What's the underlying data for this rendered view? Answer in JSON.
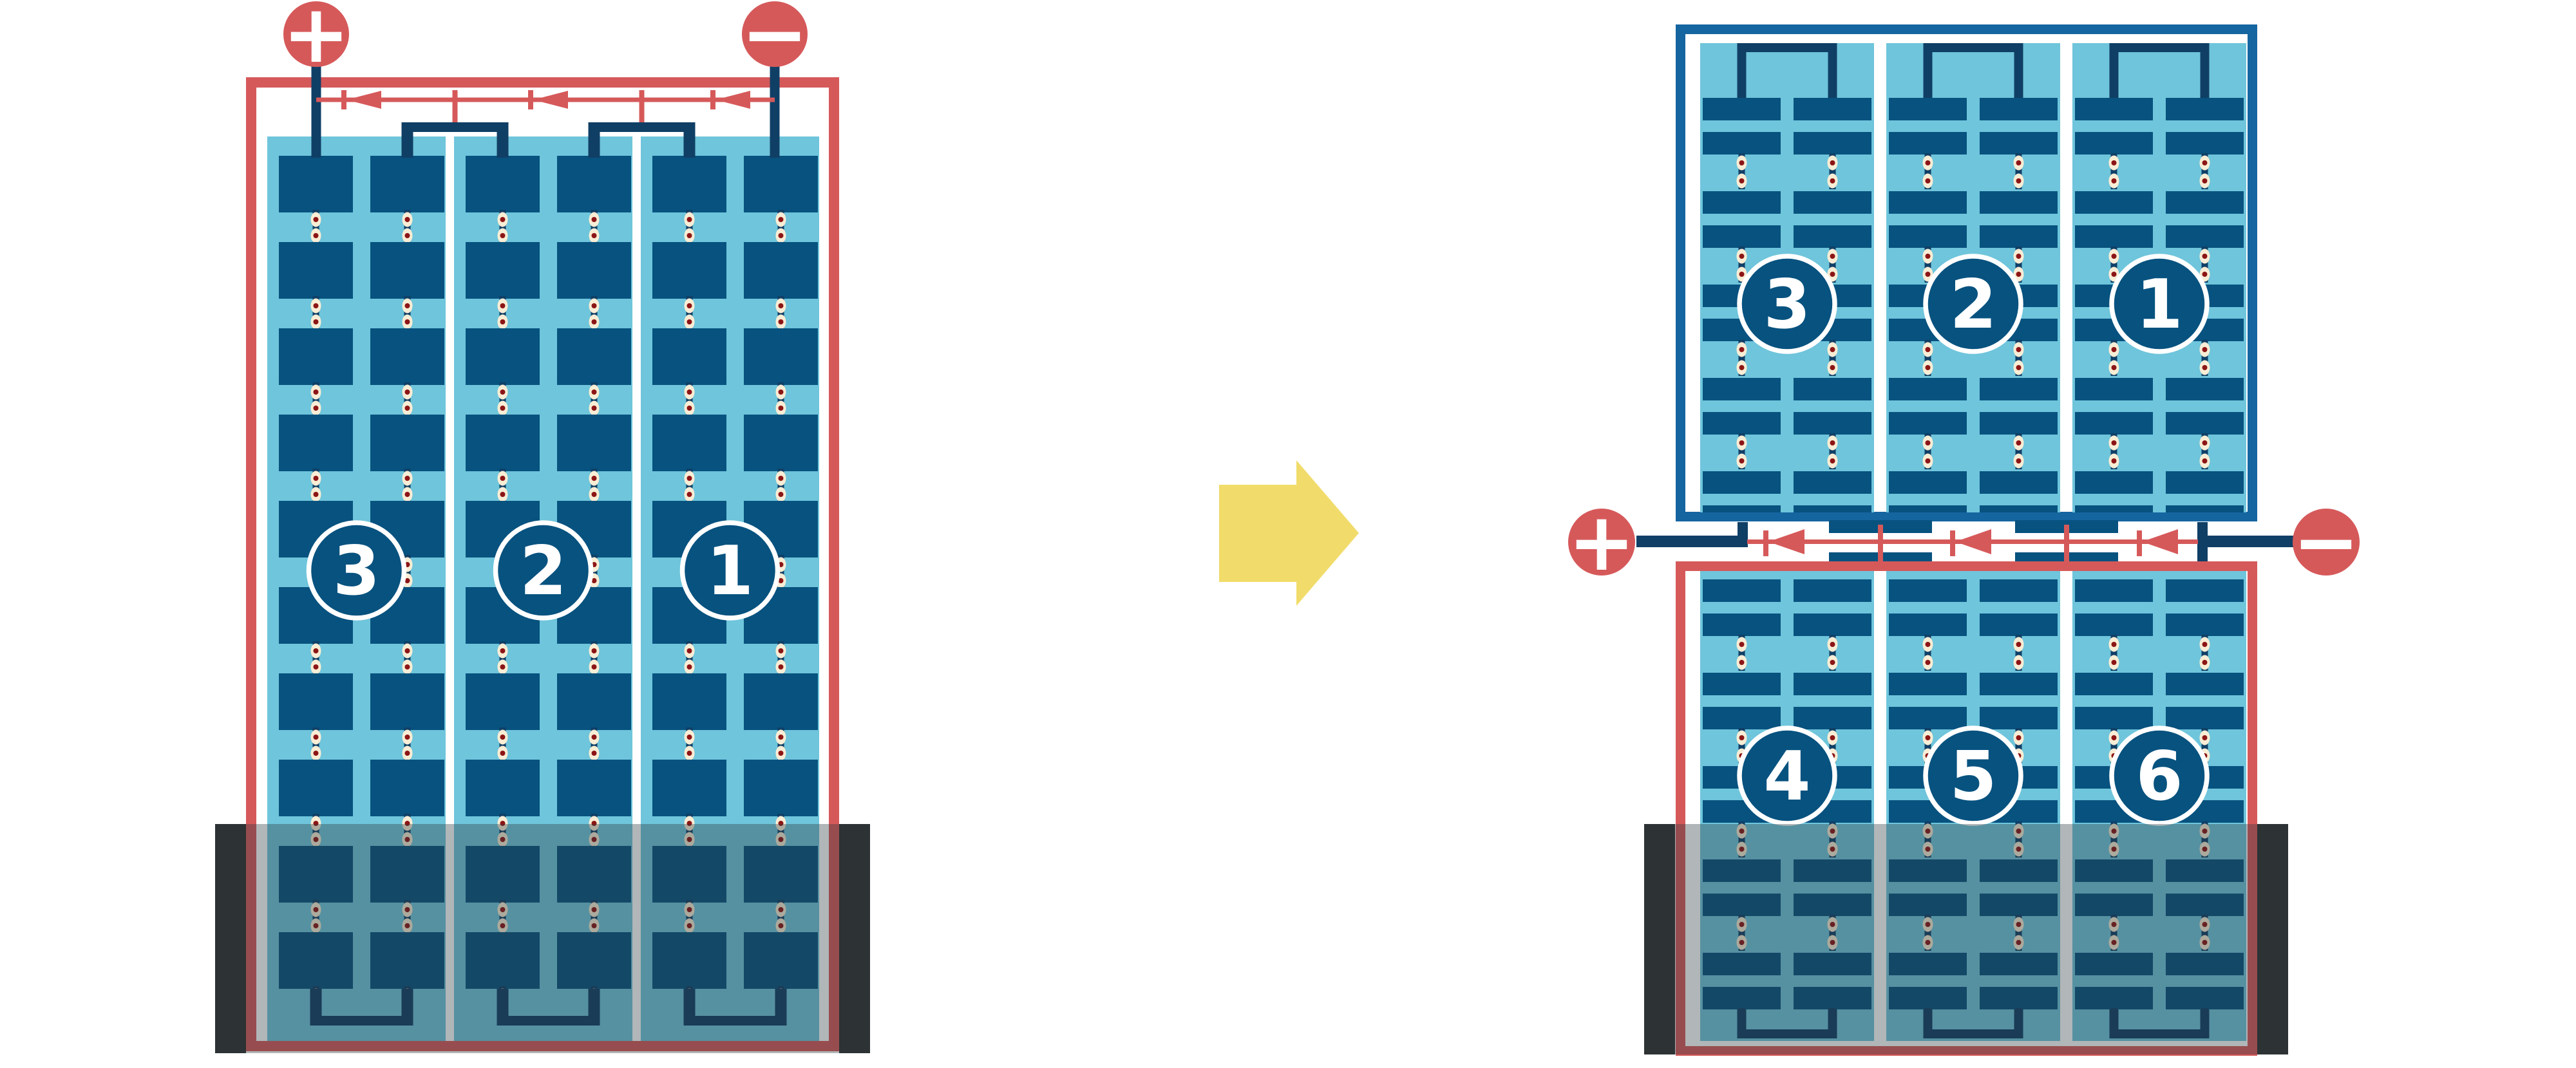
{
  "colors": {
    "background": "#ffffff",
    "red": "#d6595a",
    "frame_blue": "#1565a0",
    "cell_blue": "#07527f",
    "wire_navy": "#103f66",
    "cyan": "#6fc5db",
    "cream": "#f8edd5",
    "dot_red": "#8c1515",
    "yellow": "#f1dc6b",
    "shade": "rgba(44,56,62,0.37)",
    "edge_bar": "#2f2f2f"
  },
  "icons": {
    "positive_terminal": "plus-circle",
    "negative_terminal": "minus-circle",
    "bypass_diode": "left-pointing-diode",
    "transition": "right-arrow",
    "cell_joint": "solder-dot"
  },
  "left_panel": {
    "terminals": {
      "positive": "+",
      "negative": "−"
    },
    "string_labels": [
      "3",
      "2",
      "1"
    ]
  },
  "right_structure": {
    "terminals": {
      "positive": "+",
      "negative": "−"
    },
    "top_panel": {
      "string_labels": [
        "3",
        "2",
        "1"
      ]
    },
    "bottom_panel": {
      "string_labels": [
        "4",
        "5",
        "6"
      ]
    }
  }
}
